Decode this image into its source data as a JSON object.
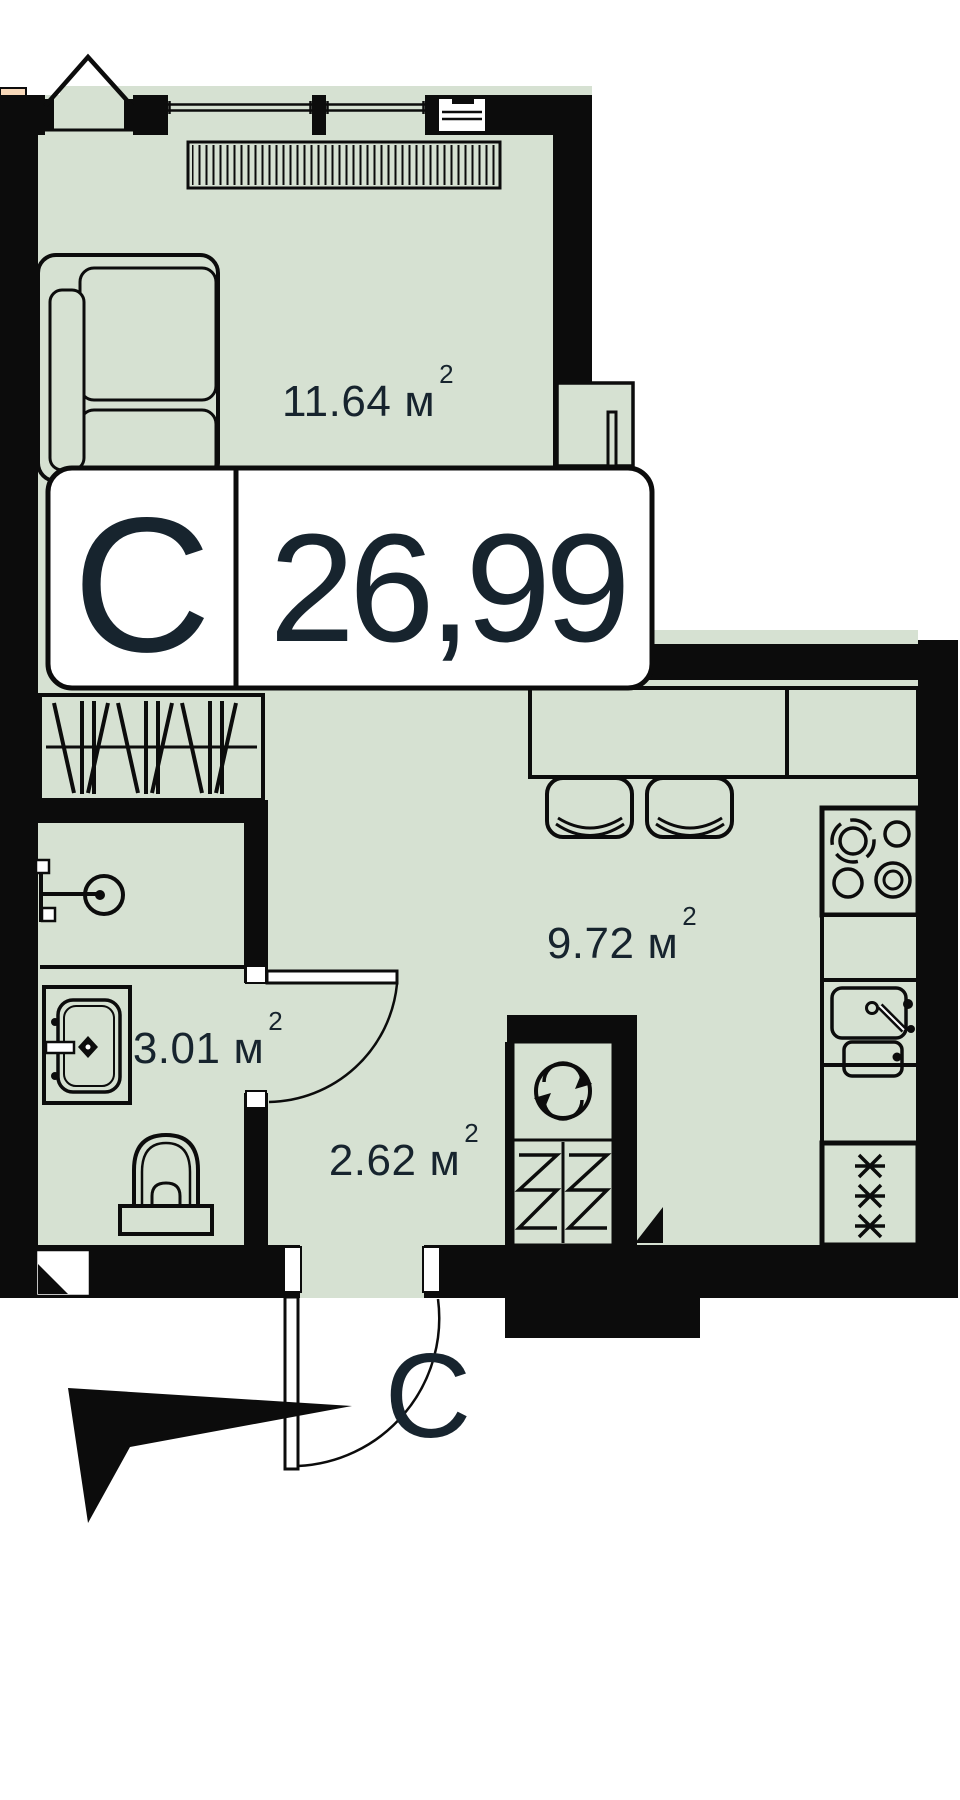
{
  "plan": {
    "badge": {
      "block_letter": "С",
      "total_area": "26,99"
    },
    "rooms": [
      {
        "id": "living-room",
        "area": "11.64"
      },
      {
        "id": "kitchen",
        "area": "9.72"
      },
      {
        "id": "bathroom",
        "area": "3.01"
      },
      {
        "id": "hallway",
        "area": "2.62"
      }
    ],
    "units": {
      "area_unit": "м",
      "area_exponent": "2"
    },
    "compass": {
      "north_label": "С"
    },
    "colors": {
      "floor": "#d6e1d2",
      "wall": "#0c0c0c",
      "peach": "#f8d9ba",
      "text": "#17242e"
    }
  }
}
